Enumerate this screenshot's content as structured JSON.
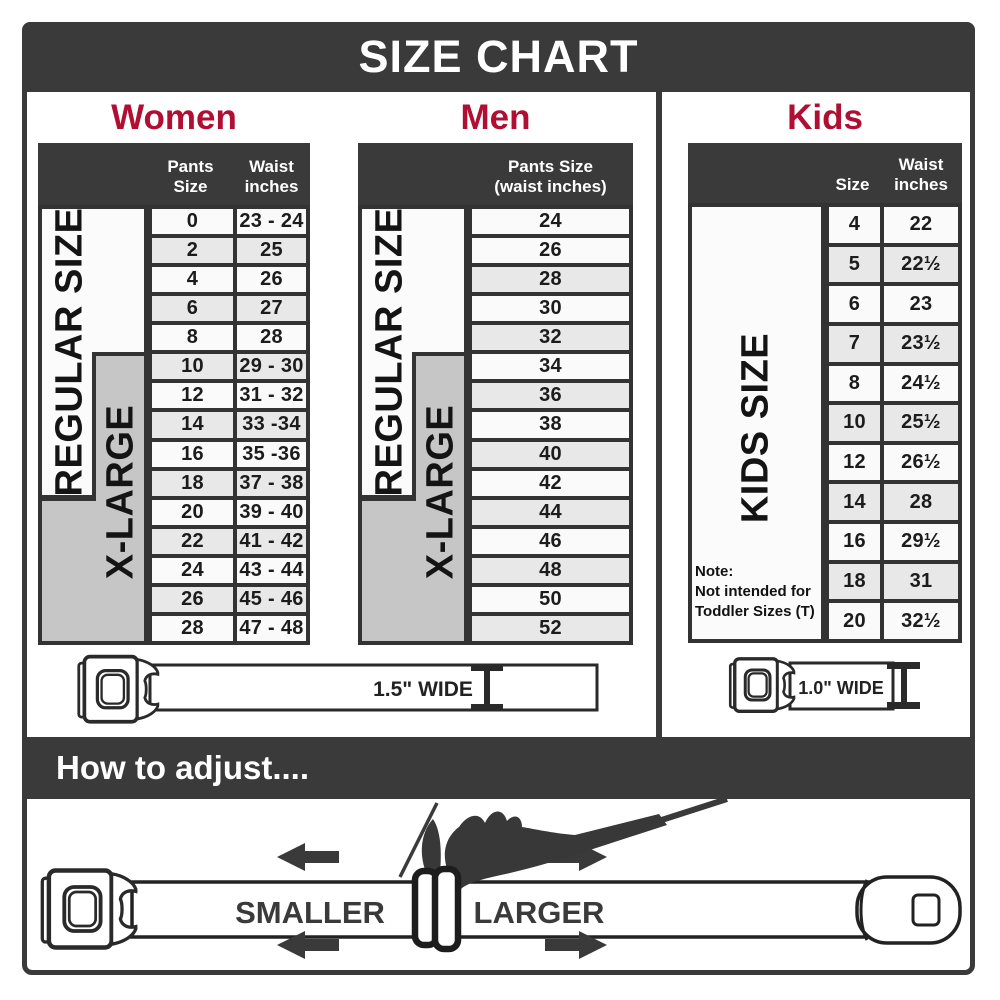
{
  "title": "SIZE CHART",
  "colors": {
    "dark_band": "#3a3a3a",
    "heading_accent": "#b00e32",
    "xlarge_gray": "#c6c6c6",
    "row_light": "#fafafa",
    "row_shaded": "#e8e8e8"
  },
  "sections": {
    "women": {
      "heading": "Women",
      "col1_header": "Pants Size",
      "col2_header_line1": "Waist",
      "col2_header_line2": "inches",
      "regular_label": "REGULAR SIZE",
      "xlarge_label": "X-LARGE",
      "rows": [
        [
          "0",
          "23 - 24"
        ],
        [
          "2",
          "25"
        ],
        [
          "4",
          "26"
        ],
        [
          "6",
          "27"
        ],
        [
          "8",
          "28"
        ],
        [
          "10",
          "29 - 30"
        ],
        [
          "12",
          "31 - 32"
        ],
        [
          "14",
          "33 -34"
        ],
        [
          "16",
          "35 -36"
        ],
        [
          "18",
          "37 - 38"
        ],
        [
          "20",
          "39 - 40"
        ],
        [
          "22",
          "41 - 42"
        ],
        [
          "24",
          "43 - 44"
        ],
        [
          "26",
          "45 - 46"
        ],
        [
          "28",
          "47 - 48"
        ]
      ]
    },
    "men": {
      "heading": "Men",
      "col_header_line1": "Pants Size",
      "col_header_line2": "(waist inches)",
      "regular_label": "REGULAR SIZE",
      "xlarge_label": "X-LARGE",
      "rows": [
        "24",
        "26",
        "28",
        "30",
        "32",
        "34",
        "36",
        "38",
        "40",
        "42",
        "44",
        "46",
        "48",
        "50",
        "52"
      ]
    },
    "kids": {
      "heading": "Kids",
      "col1_header": "Size",
      "col2_header_line1": "Waist",
      "col2_header_line2": "inches",
      "label": "KIDS SIZE",
      "note_line1": "Note:",
      "note_line2": "Not intended for",
      "note_line3": "Toddler Sizes (T)",
      "rows": [
        [
          "4",
          "22"
        ],
        [
          "5",
          "22½"
        ],
        [
          "6",
          "23"
        ],
        [
          "7",
          "23½"
        ],
        [
          "8",
          "24½"
        ],
        [
          "10",
          "25½"
        ],
        [
          "12",
          "26½"
        ],
        [
          "14",
          "28"
        ],
        [
          "16",
          "29½"
        ],
        [
          "18",
          "31"
        ],
        [
          "20",
          "32½"
        ]
      ]
    }
  },
  "belts": {
    "adult_width_label": "1.5\" WIDE",
    "kids_width_label": "1.0\" WIDE"
  },
  "adjust": {
    "heading": "How to adjust....",
    "smaller_label": "SMALLER",
    "larger_label": "LARGER"
  }
}
